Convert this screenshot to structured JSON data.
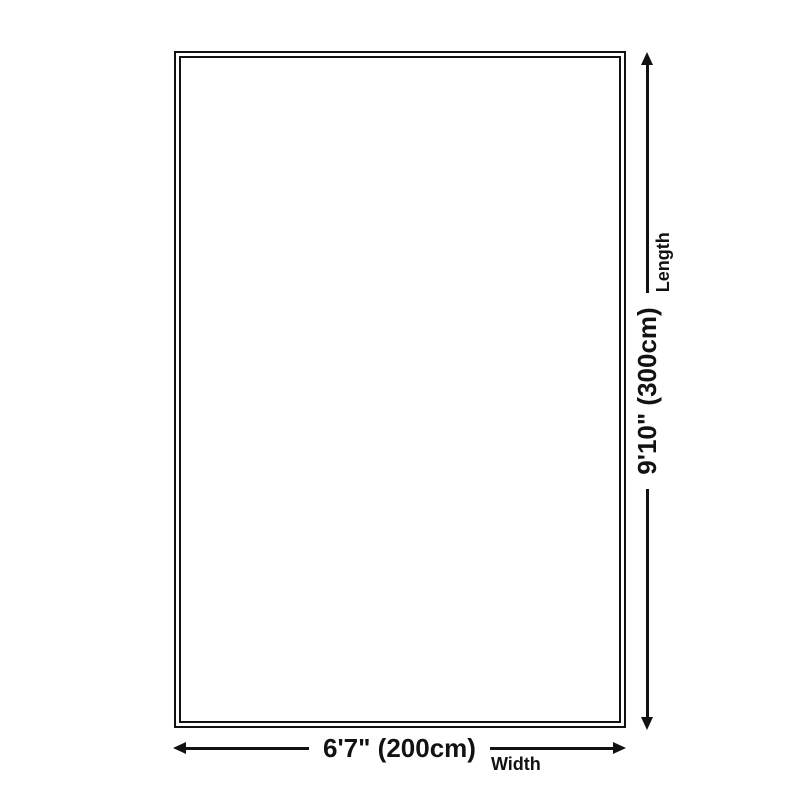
{
  "diagram": {
    "title": "rug-size-diagram",
    "line_color": "#121212",
    "text_color": "#121212",
    "background_color": "#ffffff",
    "width_dim": {
      "value": "6'7\" (200cm)",
      "label": "Width"
    },
    "length_dim": {
      "value": "9'10\" (300cm)",
      "label": "Length"
    }
  }
}
